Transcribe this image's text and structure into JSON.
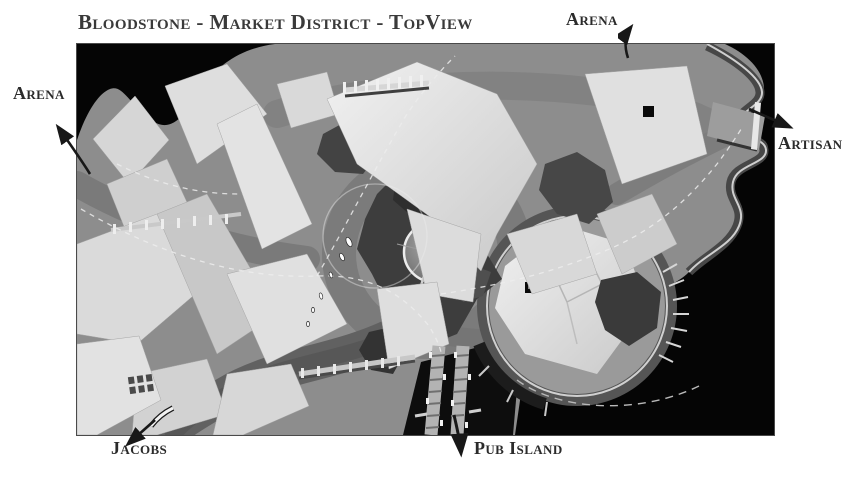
{
  "title": "Bloodstone - Market District - TopView",
  "map": {
    "name": "grayscale top-down 3d render of the market district",
    "background_color": "#000000",
    "terrain_color": "#8d8d8d",
    "rooftop_color": "#e2e2e2",
    "exits": [
      {
        "id": "arena-west",
        "label": "Arena",
        "direction": "up-left"
      },
      {
        "id": "arena-north",
        "label": "Arena",
        "direction": "up"
      },
      {
        "id": "artisan-east",
        "label": "Artisan",
        "direction": "down-right"
      },
      {
        "id": "jacobs-southwest",
        "label": "Jacobs",
        "direction": "down-left"
      },
      {
        "id": "pub-island-south",
        "label": "Pub Island",
        "direction": "down"
      }
    ]
  },
  "colors": {
    "page_background": "#ffffff",
    "text": "#3a3a3a",
    "arrow": "#181818"
  }
}
